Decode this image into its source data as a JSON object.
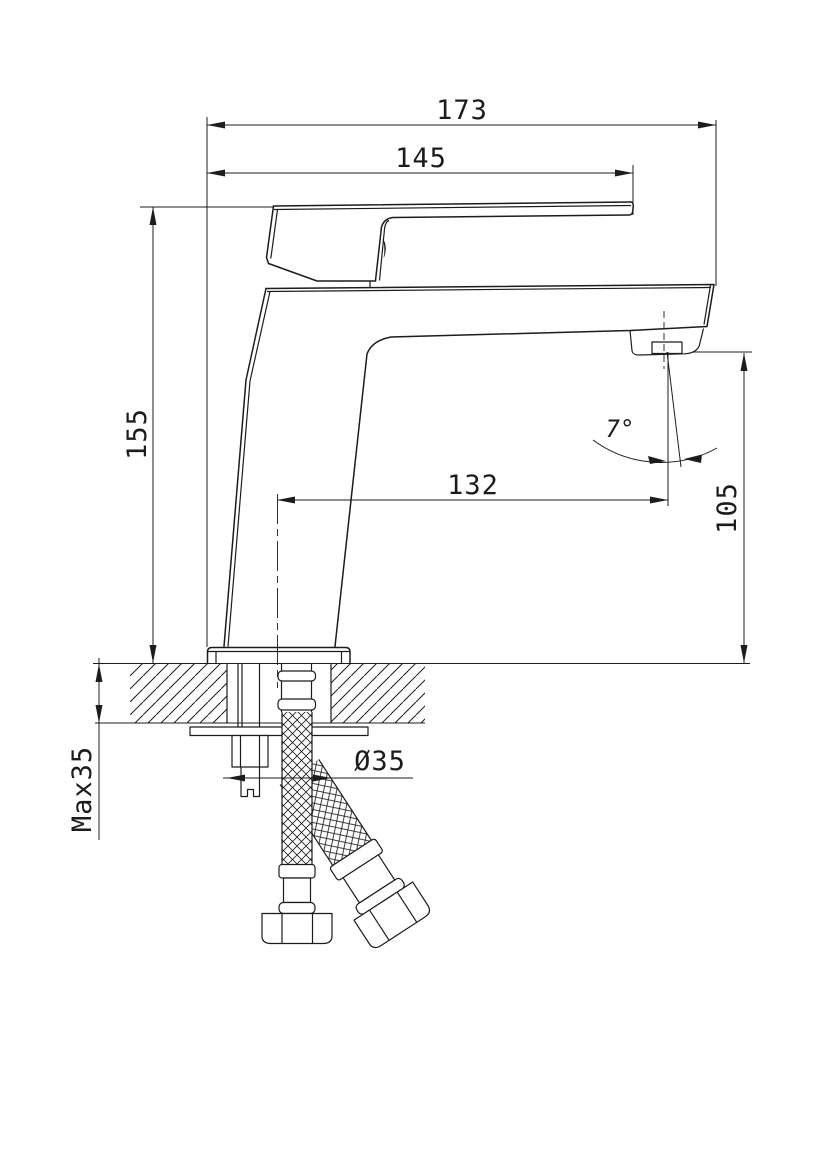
{
  "colors": {
    "background": "#ffffff",
    "line": "#1c1c1c"
  },
  "drawing": {
    "dimensions": {
      "overall_width": "173",
      "handle_reach": "145",
      "total_height": "155",
      "spout_reach": "132",
      "spout_outlet_height": "105",
      "spout_angle": "7°",
      "mounting_hole_diameter": "Ø35",
      "max_mounting_thickness": "Max35"
    }
  }
}
